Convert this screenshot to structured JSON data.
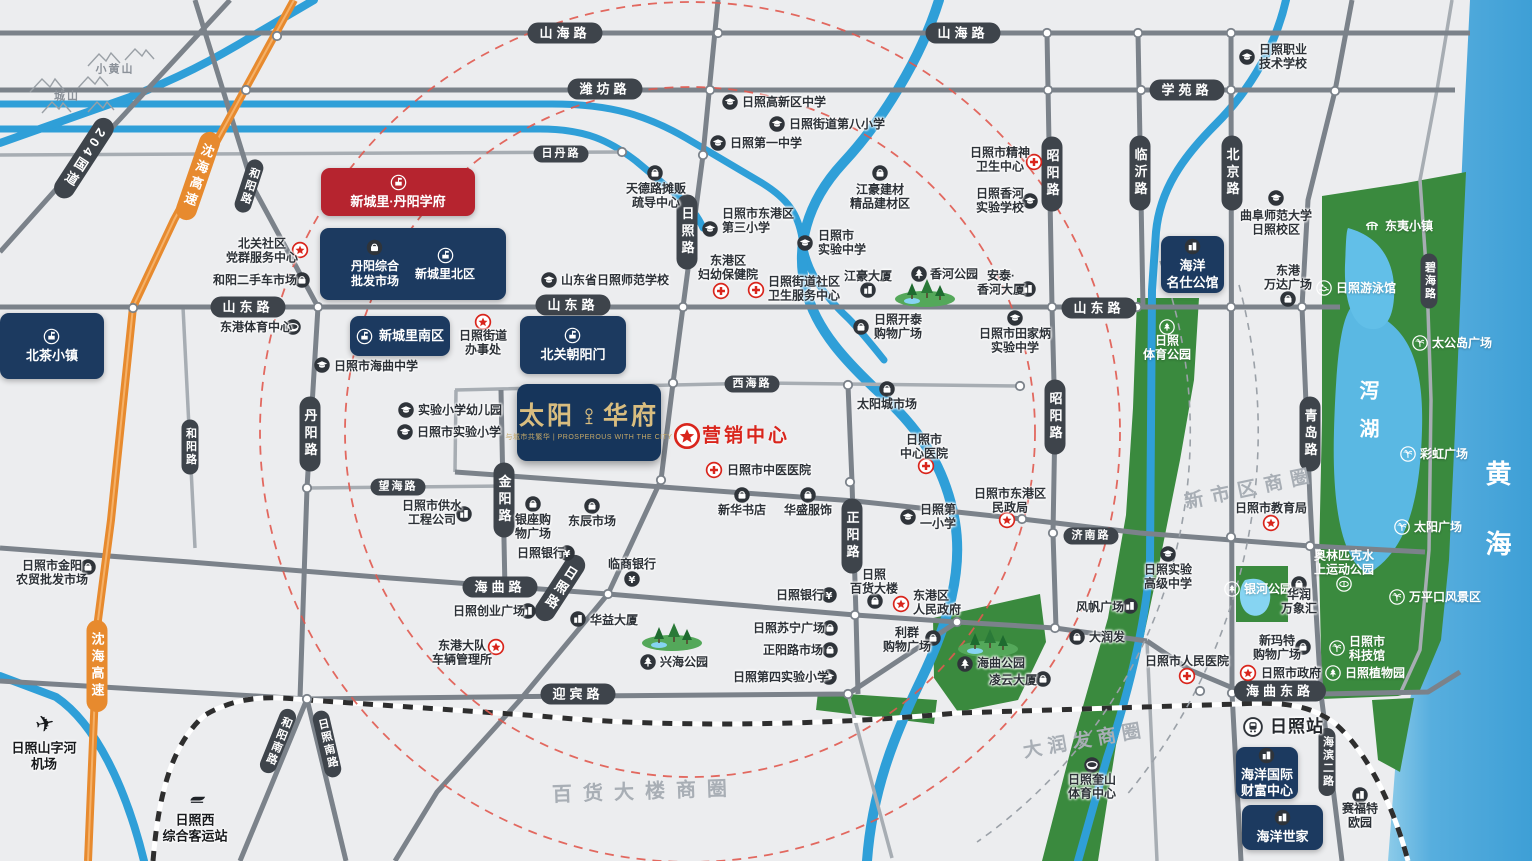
{
  "project": {
    "t1": "太阳",
    "t2": "华府",
    "tag": "与城市共繁华 | PROSPEROUS WITH THE CITY",
    "x": 517,
    "y": 384,
    "w": 144,
    "h": 77
  },
  "marketing": {
    "t": "营销中心",
    "sx": 687,
    "sy": 436,
    "tx": 702,
    "ty": 436
  },
  "colors": {
    "navy": "#1c3a60",
    "red_box": "#b6242f",
    "pill": "#3e444b",
    "highway_orange": "#e78a2e",
    "poi_red": "#d9251c",
    "sea": "#3e9fd6",
    "green": "#3a8a3e",
    "river": "#2f9fd8",
    "gold": "#d9bd7f"
  },
  "road_labels": [
    {
      "t": "山海路",
      "x": 565,
      "y": 33,
      "o": "h"
    },
    {
      "t": "山海路",
      "x": 963,
      "y": 33,
      "o": "h"
    },
    {
      "t": "潍坊路",
      "x": 605,
      "y": 89,
      "o": "h"
    },
    {
      "t": "日丹路",
      "x": 561,
      "y": 154,
      "o": "h",
      "small": true
    },
    {
      "t": "学苑路",
      "x": 1187,
      "y": 90,
      "o": "h"
    },
    {
      "t": "山东路",
      "x": 248,
      "y": 307,
      "o": "h"
    },
    {
      "t": "山东路",
      "x": 573,
      "y": 305,
      "o": "h"
    },
    {
      "t": "山东路",
      "x": 1099,
      "y": 308,
      "o": "h"
    },
    {
      "t": "西海路",
      "x": 752,
      "y": 384,
      "o": "h",
      "small": true
    },
    {
      "t": "望海路",
      "x": 398,
      "y": 487,
      "o": "h",
      "small": true
    },
    {
      "t": "海曲路",
      "x": 500,
      "y": 587,
      "o": "h"
    },
    {
      "t": "济南路",
      "x": 1091,
      "y": 536,
      "o": "h",
      "small": true
    },
    {
      "t": "迎宾路",
      "x": 578,
      "y": 694,
      "o": "h"
    },
    {
      "t": "海曲东路",
      "x": 1280,
      "y": 691,
      "o": "h"
    },
    {
      "t": "日照路",
      "x": 687,
      "y": 232,
      "o": "v"
    },
    {
      "t": "日照路",
      "x": 560,
      "y": 588,
      "o": "v",
      "angle": 33
    },
    {
      "t": "丹阳路",
      "x": 310,
      "y": 434,
      "o": "v"
    },
    {
      "t": "和阳路",
      "x": 249,
      "y": 186,
      "o": "v",
      "angle": 18,
      "small": true
    },
    {
      "t": "和阳路",
      "x": 190,
      "y": 447,
      "o": "v",
      "small": true
    },
    {
      "t": "金阳路",
      "x": 504,
      "y": 500,
      "o": "v"
    },
    {
      "t": "正阳路",
      "x": 852,
      "y": 536,
      "o": "v"
    },
    {
      "t": "昭阳路",
      "x": 1052,
      "y": 174,
      "o": "v"
    },
    {
      "t": "昭阳路",
      "x": 1055,
      "y": 417,
      "o": "v"
    },
    {
      "t": "临沂路",
      "x": 1140,
      "y": 173,
      "o": "v"
    },
    {
      "t": "北京路",
      "x": 1232,
      "y": 173,
      "o": "v"
    },
    {
      "t": "青岛路",
      "x": 1310,
      "y": 434,
      "o": "v"
    },
    {
      "t": "碧海路",
      "x": 1429,
      "y": 281,
      "o": "v",
      "small": true
    },
    {
      "t": "海滨二路",
      "x": 1327,
      "y": 762,
      "o": "v",
      "small": true
    },
    {
      "t": "和阳南路",
      "x": 278,
      "y": 741,
      "o": "v",
      "angle": 22,
      "small": true
    },
    {
      "t": "日照南路",
      "x": 327,
      "y": 744,
      "o": "v",
      "angle": -13,
      "small": true
    },
    {
      "t": "204国道",
      "x": 84,
      "y": 158,
      "o": "v",
      "angle": 33
    },
    {
      "t": "沈海高速",
      "x": 198,
      "y": 176,
      "o": "v",
      "angle": 19,
      "cls": "orange"
    },
    {
      "t": "沈海高速",
      "x": 97,
      "y": 666,
      "o": "v",
      "cls": "orange"
    }
  ],
  "estates": [
    {
      "t": "新城里·丹阳学府",
      "x": 321,
      "y": 168,
      "w": 154,
      "h": 48,
      "v": "red",
      "ic": "badge",
      "lay": "col"
    },
    {
      "x": 320,
      "y": 228,
      "w": 186,
      "h": 72,
      "v": "navy",
      "entries": [
        {
          "ic": "shop",
          "t": "丹阳综合\n批发市场"
        },
        {
          "ic": "badge",
          "t": "新城里北区"
        }
      ]
    },
    {
      "t": "北茶小镇",
      "x": 0,
      "y": 313,
      "w": 104,
      "h": 66,
      "v": "navy",
      "ic": "badge",
      "lay": "col"
    },
    {
      "t": "新城里南区",
      "x": 350,
      "y": 316,
      "w": 100,
      "h": 40,
      "v": "navy",
      "ic": "badge",
      "lay": "row"
    },
    {
      "t": "北关朝阳门",
      "x": 520,
      "y": 316,
      "w": 106,
      "h": 58,
      "v": "navy",
      "ic": "badge",
      "lay": "col"
    },
    {
      "t": "海洋\n名仕公馆",
      "x": 1161,
      "y": 236,
      "w": 63,
      "h": 57,
      "v": "navy",
      "ic": "building",
      "lay": "col"
    },
    {
      "t": "海洋国际\n财富中心",
      "x": 1236,
      "y": 747,
      "w": 62,
      "h": 52,
      "v": "navy",
      "ic": "building",
      "lay": "col"
    },
    {
      "t": "海洋世家",
      "x": 1242,
      "y": 805,
      "w": 81,
      "h": 45,
      "v": "navy",
      "ic": "building",
      "lay": "col"
    }
  ],
  "pois": [
    {
      "t": "日照职业\n技术学校",
      "tx": 1259,
      "ty": 57,
      "ix": 1247,
      "iy": 57,
      "ic": "school",
      "al": "l"
    },
    {
      "t": "日照高新区中学",
      "tx": 742,
      "ty": 102,
      "ix": 730,
      "iy": 102,
      "ic": "school",
      "al": "l"
    },
    {
      "t": "日照街道第八小学",
      "tx": 789,
      "ty": 124,
      "ix": 777,
      "iy": 124,
      "ic": "school",
      "al": "l"
    },
    {
      "t": "日照第一中学",
      "tx": 730,
      "ty": 143,
      "ix": 718,
      "iy": 143,
      "ic": "school",
      "al": "l"
    },
    {
      "t": "天德路摊贩\n疏导中心",
      "tx": 656,
      "ty": 196,
      "ix": 655,
      "iy": 173,
      "ic": "shop",
      "al": "c"
    },
    {
      "t": "日照市东港区\n第三小学",
      "tx": 722,
      "ty": 221,
      "ix": 710,
      "iy": 229,
      "ic": "school",
      "al": "l"
    },
    {
      "t": "日照市\n实验中学",
      "tx": 818,
      "ty": 243,
      "ix": 805,
      "iy": 243,
      "ic": "school",
      "al": "l"
    },
    {
      "t": "江豪建材\n精品建材区",
      "tx": 880,
      "ty": 197,
      "ix": 880,
      "iy": 173,
      "ic": "shop",
      "al": "c"
    },
    {
      "t": "日照市精神\n卫生中心",
      "tx": 1000,
      "ty": 160,
      "ix": 1034,
      "iy": 162,
      "ic": "hospital",
      "al": "c"
    },
    {
      "t": "日照香河\n实验学校",
      "tx": 1000,
      "ty": 201,
      "ix": 1030,
      "iy": 201,
      "ic": "school",
      "al": "c"
    },
    {
      "t": "曲阜师范大学\n日照校区",
      "tx": 1276,
      "ty": 223,
      "ix": 1276,
      "iy": 198,
      "ic": "school",
      "al": "c"
    },
    {
      "t": "北关社区\n党群服务中心",
      "tx": 262,
      "ty": 251,
      "ix": 300,
      "iy": 250,
      "ic": "star",
      "al": "c"
    },
    {
      "t": "和阳二手车市场",
      "tx": 255,
      "ty": 280,
      "ix": 302,
      "iy": 280,
      "ic": "shop",
      "al": "c"
    },
    {
      "t": "山东省日照师范学校",
      "tx": 561,
      "ty": 280,
      "ix": 549,
      "iy": 280,
      "ic": "school",
      "al": "l"
    },
    {
      "t": "东港区\n妇幼保健院",
      "tx": 728,
      "ty": 268,
      "ix": 721,
      "iy": 291,
      "ic": "hospital",
      "al": "c"
    },
    {
      "t": "日照街道社区\n卫生服务中心",
      "tx": 768,
      "ty": 289,
      "ix": 756,
      "iy": 290,
      "ic": "hospital",
      "al": "l"
    },
    {
      "t": "江豪大厦",
      "tx": 868,
      "ty": 276,
      "ix": 868,
      "iy": 290,
      "ic": "building",
      "al": "c"
    },
    {
      "t": "香河公园",
      "tx": 930,
      "ty": 274,
      "ix": 919,
      "iy": 274,
      "ic": "park",
      "al": "l"
    },
    {
      "t": "安泰·\n香河大厦",
      "tx": 1001,
      "ty": 283,
      "ix": 1028,
      "iy": 289,
      "ic": "building",
      "al": "c"
    },
    {
      "t": "日照开泰\n购物广场",
      "tx": 874,
      "ty": 327,
      "ix": 861,
      "iy": 327,
      "ic": "shop",
      "al": "l"
    },
    {
      "t": "日照市田家炳\n实验中学",
      "tx": 1015,
      "ty": 341,
      "ix": 1015,
      "iy": 318,
      "ic": "school",
      "al": "c"
    },
    {
      "t": "日照市海曲中学",
      "tx": 334,
      "ty": 366,
      "ix": 322,
      "iy": 365,
      "ic": "school",
      "al": "l"
    },
    {
      "t": "日照街道\n办事处",
      "tx": 483,
      "ty": 343,
      "ix": 483,
      "iy": 322,
      "ic": "star",
      "al": "c"
    },
    {
      "t": "东港体育中心",
      "tx": 256,
      "ty": 327,
      "ix": 293,
      "iy": 327,
      "ic": "stadium",
      "al": "c"
    },
    {
      "t": "实验小学幼儿园",
      "tx": 418,
      "ty": 410,
      "ix": 406,
      "iy": 410,
      "ic": "school",
      "al": "l"
    },
    {
      "t": "日照市实验小学",
      "tx": 417,
      "ty": 432,
      "ix": 405,
      "iy": 432,
      "ic": "school",
      "al": "l"
    },
    {
      "t": "日照市供水\n工程公司",
      "tx": 432,
      "ty": 513,
      "ix": 464,
      "iy": 514,
      "ic": "building",
      "al": "c"
    },
    {
      "t": "日照市金阳\n农贸批发市场",
      "tx": 52,
      "ty": 573,
      "ix": 88,
      "iy": 567,
      "ic": "shop",
      "al": "c"
    },
    {
      "t": "银座购\n物广场",
      "tx": 533,
      "ty": 527,
      "ix": 533,
      "iy": 504,
      "ic": "shop",
      "al": "c"
    },
    {
      "t": "东辰市场",
      "tx": 592,
      "ty": 521,
      "ix": 592,
      "iy": 506,
      "ic": "shop",
      "al": "c"
    },
    {
      "t": "日照银行",
      "tx": 541,
      "ty": 553,
      "ix": 567,
      "iy": 553,
      "ic": "bank",
      "al": "c"
    },
    {
      "t": "临商银行",
      "tx": 632,
      "ty": 564,
      "ix": 632,
      "iy": 579,
      "ic": "bank",
      "al": "c"
    },
    {
      "t": "日照创业广场",
      "tx": 489,
      "ty": 611,
      "ix": 528,
      "iy": 611,
      "ic": "building",
      "al": "c"
    },
    {
      "t": "华益大厦",
      "tx": 590,
      "ty": 620,
      "ix": 578,
      "iy": 619,
      "ic": "building",
      "al": "l"
    },
    {
      "t": "东港大队\n车辆管理所",
      "tx": 462,
      "ty": 653,
      "ix": 496,
      "iy": 647,
      "ic": "star",
      "al": "c"
    },
    {
      "t": "新华书店",
      "tx": 742,
      "ty": 510,
      "ix": 742,
      "iy": 495,
      "ic": "shop",
      "al": "c"
    },
    {
      "t": "华盛服饰",
      "tx": 808,
      "ty": 510,
      "ix": 808,
      "iy": 495,
      "ic": "shop",
      "al": "c"
    },
    {
      "t": "日照市中医医院",
      "tx": 727,
      "ty": 470,
      "ix": 714,
      "iy": 470,
      "ic": "hospital",
      "al": "l"
    },
    {
      "t": "太阳城市场",
      "tx": 887,
      "ty": 404,
      "ix": 887,
      "iy": 389,
      "ic": "shop",
      "al": "c"
    },
    {
      "t": "日照市\n中心医院",
      "tx": 924,
      "ty": 447,
      "ix": 926,
      "iy": 466,
      "ic": "hospital",
      "al": "c"
    },
    {
      "t": "日照第\n一小学",
      "tx": 920,
      "ty": 517,
      "ix": 908,
      "iy": 517,
      "ic": "school",
      "al": "l"
    },
    {
      "t": "日照市东港区\n民政局",
      "tx": 1010,
      "ty": 501,
      "ix": 1007,
      "iy": 520,
      "ic": "star",
      "al": "c"
    },
    {
      "t": "日照市教育局",
      "tx": 1271,
      "ty": 508,
      "ix": 1271,
      "iy": 523,
      "ic": "star",
      "al": "c"
    },
    {
      "t": "日照\n体育公园",
      "tx": 1167,
      "ty": 348,
      "ix": 1167,
      "iy": 327,
      "ic": "w-park",
      "al": "c",
      "cl": "w"
    },
    {
      "t": "日照实验\n高级中学",
      "tx": 1168,
      "ty": 577,
      "ix": 1168,
      "iy": 554,
      "ic": "school",
      "al": "c"
    },
    {
      "t": "风帆广场",
      "tx": 1100,
      "ty": 607,
      "ix": 1130,
      "iy": 606,
      "ic": "building",
      "al": "c"
    },
    {
      "t": "大润发",
      "tx": 1089,
      "ty": 637,
      "ix": 1077,
      "iy": 637,
      "ic": "shop",
      "al": "l"
    },
    {
      "t": "日照市人民医院",
      "tx": 1187,
      "ty": 661,
      "ix": 1187,
      "iy": 676,
      "ic": "hospital",
      "al": "c"
    },
    {
      "t": "银河公园",
      "tx": 1244,
      "ty": 589,
      "ix": 1232,
      "iy": 589,
      "ic": "w-park",
      "al": "l",
      "cl": "w"
    },
    {
      "t": "华润\n万象汇",
      "tx": 1299,
      "ty": 602,
      "ix": 1299,
      "iy": 584,
      "ic": "shop",
      "al": "c"
    },
    {
      "t": "新玛特\n购物广场",
      "tx": 1277,
      "ty": 648,
      "ix": 1303,
      "iy": 647,
      "ic": "shop",
      "al": "c"
    },
    {
      "t": "日照市政府",
      "tx": 1261,
      "ty": 673,
      "ix": 1248,
      "iy": 673,
      "ic": "star",
      "al": "l"
    },
    {
      "t": "日照站",
      "tx": 1270,
      "ty": 727,
      "ix": 1253,
      "iy": 727,
      "ic": "rail",
      "al": "l",
      "cl": "b2"
    },
    {
      "t": "赛福特\n欧园",
      "tx": 1360,
      "ty": 816,
      "ix": 1360,
      "iy": 795,
      "ic": "building",
      "al": "c"
    },
    {
      "t": "日照奎山\n体育中心",
      "tx": 1092,
      "ty": 787,
      "ix": 1092,
      "iy": 765,
      "ic": "stadium",
      "al": "c"
    },
    {
      "t": "奥林匹克水\n上运动公园",
      "tx": 1344,
      "ty": 563,
      "ix": 1344,
      "iy": 584,
      "ic": "w-stadium",
      "al": "c",
      "cl": "w"
    },
    {
      "t": "万平口风景区",
      "tx": 1409,
      "ty": 597,
      "ix": 1397,
      "iy": 597,
      "ic": "w-palm",
      "al": "l",
      "cl": "w"
    },
    {
      "t": "日照市\n科技馆",
      "tx": 1349,
      "ty": 649,
      "ix": 1337,
      "iy": 648,
      "ic": "w-palm",
      "al": "l",
      "cl": "w"
    },
    {
      "t": "日照植物园",
      "tx": 1345,
      "ty": 673,
      "ix": 1333,
      "iy": 673,
      "ic": "w-park",
      "al": "l",
      "cl": "w"
    },
    {
      "t": "太公岛广场",
      "tx": 1432,
      "ty": 343,
      "ix": 1420,
      "iy": 343,
      "ic": "w-palm",
      "al": "l",
      "cl": "w"
    },
    {
      "t": "彩虹广场",
      "tx": 1420,
      "ty": 454,
      "ix": 1408,
      "iy": 454,
      "ic": "w-palm",
      "al": "l",
      "cl": "w"
    },
    {
      "t": "太阳广场",
      "tx": 1414,
      "ty": 527,
      "ix": 1402,
      "iy": 527,
      "ic": "w-palm",
      "al": "l",
      "cl": "w"
    },
    {
      "t": "日照游泳馆",
      "tx": 1336,
      "ty": 288,
      "ix": 1324,
      "iy": 288,
      "ic": "w-swim",
      "al": "l",
      "cl": "w"
    },
    {
      "t": "东夷小镇",
      "tx": 1385,
      "ty": 226,
      "ix": 1372,
      "iy": 226,
      "ic": "w-town",
      "al": "l",
      "cl": "w"
    },
    {
      "t": "东港\n万达广场",
      "tx": 1288,
      "ty": 278,
      "ix": 1288,
      "iy": 299,
      "ic": "shop",
      "al": "c"
    },
    {
      "t": "兴海公园",
      "tx": 660,
      "ty": 662,
      "ix": 648,
      "iy": 662,
      "ic": "park",
      "al": "l"
    },
    {
      "t": "海曲公园",
      "tx": 977,
      "ty": 663,
      "ix": 965,
      "iy": 664,
      "ic": "park",
      "al": "l"
    },
    {
      "t": "凌云大厦",
      "tx": 1013,
      "ty": 680,
      "ix": 1043,
      "iy": 679,
      "ic": "shop",
      "al": "c"
    },
    {
      "t": "利群\n购物广场",
      "tx": 907,
      "ty": 640,
      "ix": 933,
      "iy": 638,
      "ic": "shop",
      "al": "c"
    },
    {
      "t": "日照苏宁广场",
      "tx": 789,
      "ty": 628,
      "ix": 830,
      "iy": 628,
      "ic": "shop",
      "al": "c"
    },
    {
      "t": "正阳路市场",
      "tx": 793,
      "ty": 650,
      "ix": 830,
      "iy": 650,
      "ic": "shop",
      "al": "c"
    },
    {
      "t": "日照第四实验小学",
      "tx": 781,
      "ty": 677,
      "ix": 829,
      "iy": 677,
      "ic": "school",
      "al": "c"
    },
    {
      "t": "日照银行",
      "tx": 800,
      "ty": 595,
      "ix": 829,
      "iy": 595,
      "ic": "bank",
      "al": "c"
    },
    {
      "t": "日照\n百货大楼",
      "tx": 874,
      "ty": 582,
      "ix": 875,
      "iy": 601,
      "ic": "shop",
      "al": "c"
    },
    {
      "t": "东港区\n人民政府",
      "tx": 913,
      "ty": 603,
      "ix": 901,
      "iy": 604,
      "ic": "star",
      "al": "l"
    },
    {
      "t": "日照山字河\n机场",
      "tx": 44,
      "ty": 756,
      "ix": 45,
      "iy": 724,
      "ic": "plane",
      "al": "c",
      "cl": "b"
    },
    {
      "t": "日照西\n综合客运站",
      "tx": 195,
      "ty": 828,
      "ix": 197,
      "iy": 798,
      "ic": "train",
      "al": "c",
      "cl": "b"
    }
  ],
  "area_labels": [
    {
      "t": "黄海",
      "x": 1497,
      "y": 530,
      "vert": true,
      "size": 26,
      "sp": 44,
      "color": "#ffffff"
    },
    {
      "t": "泻湖",
      "x": 1367,
      "y": 418,
      "vert": true,
      "size": 20,
      "sp": 18,
      "color": "#ffffff"
    },
    {
      "t": "新市区商圈",
      "x": 1251,
      "y": 489,
      "angle": -12,
      "size": 19,
      "sp": 8,
      "color": "#a8aeb5"
    },
    {
      "t": "百货大楼商圈",
      "x": 645,
      "y": 792,
      "angle": -2,
      "size": 20,
      "sp": 11,
      "color": "#a8aeb5"
    },
    {
      "t": "大润发商圈",
      "x": 1085,
      "y": 741,
      "angle": -10,
      "size": 19,
      "sp": 6,
      "color": "#a8aeb5"
    }
  ],
  "mountain_labels": [
    {
      "t": "小黄山",
      "x": 115,
      "y": 70
    },
    {
      "t": "城山",
      "x": 67,
      "y": 97
    }
  ]
}
